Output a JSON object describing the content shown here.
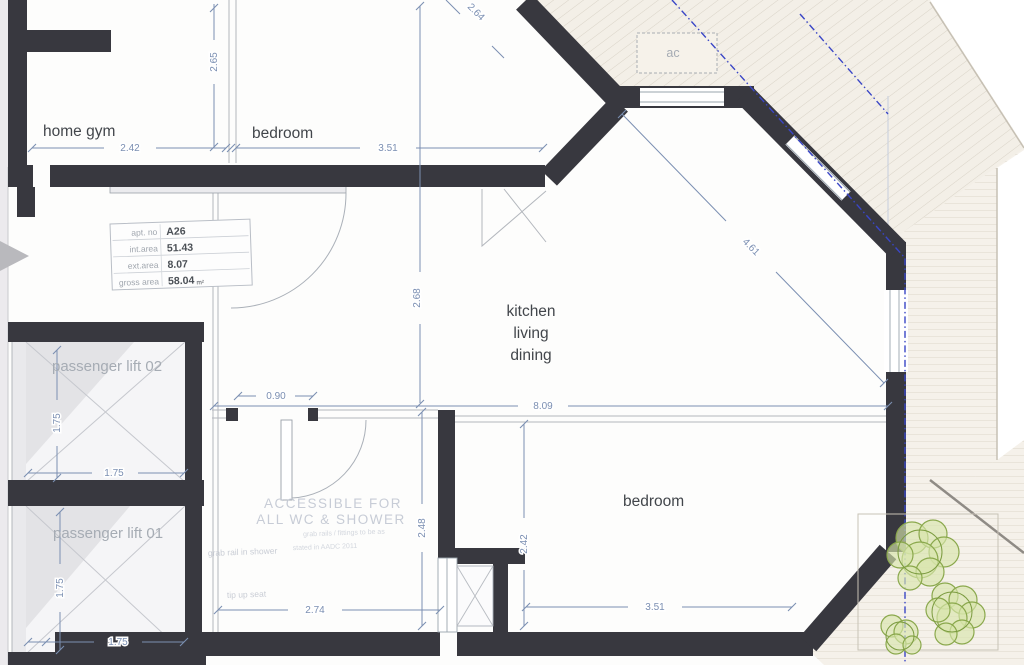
{
  "rooms": {
    "home_gym": "home gym",
    "bedroom_top": "bedroom",
    "kitchen_lines": [
      "kitchen",
      "living",
      "dining"
    ],
    "bedroom_bottom": "bedroom",
    "lift_02": "passenger lift 02",
    "lift_01": "passenger lift 01",
    "ac": "ac"
  },
  "info_table": {
    "rows": [
      {
        "label": "apt. no",
        "value": "A26"
      },
      {
        "label": "int.area",
        "value": "51.43"
      },
      {
        "label": "ext.area",
        "value": "8.07"
      },
      {
        "label": "gross area",
        "value": "58.04",
        "unit": "m²"
      }
    ]
  },
  "dimensions": {
    "gym_width": "2.42",
    "bedroom_top_width": "3.51",
    "partition_height": "2.65",
    "kitchen_height": "2.68",
    "kitchen_width": "8.09",
    "diagonal": "4.61",
    "door_width": "0.90",
    "lift02_height": "1.75",
    "lift02_width": "1.75",
    "lift01_height": "1.75",
    "lift01_width": "1.75",
    "bathroom_height": "2.48",
    "bathroom_width": "2.74",
    "bedroom_bottom_height": "2.42",
    "bedroom_bottom_width": "3.51",
    "top_edge_partial": "2.64"
  },
  "annotations": {
    "accessible_line1": "ACCESSIBLE FOR",
    "accessible_line2": "ALL WC & SHOWER",
    "note_line1": "grab rails / fittings to be as",
    "note_line2": "stated in AADC 2011",
    "shower_note": "grab rail in shower",
    "seat_note": "tip up seat"
  },
  "icons": {
    "entrance_arrow": "entrance-direction-arrow",
    "lift_cross": "lift-shaft-cross",
    "trees": "planting-shrubs"
  },
  "colors": {
    "wall": "#38383f",
    "dim": "#7b8fb2",
    "blue": "#3a46c6",
    "deck": "#f3efe7",
    "deck_line": "#d9d3c7",
    "tree_stroke": "#8aa84c",
    "tree_fill": "#d7e5ab",
    "label": "#42464b",
    "muted": "#a6acb4",
    "watermark": "#c7ccd6",
    "thin": "#b3b7bd"
  }
}
